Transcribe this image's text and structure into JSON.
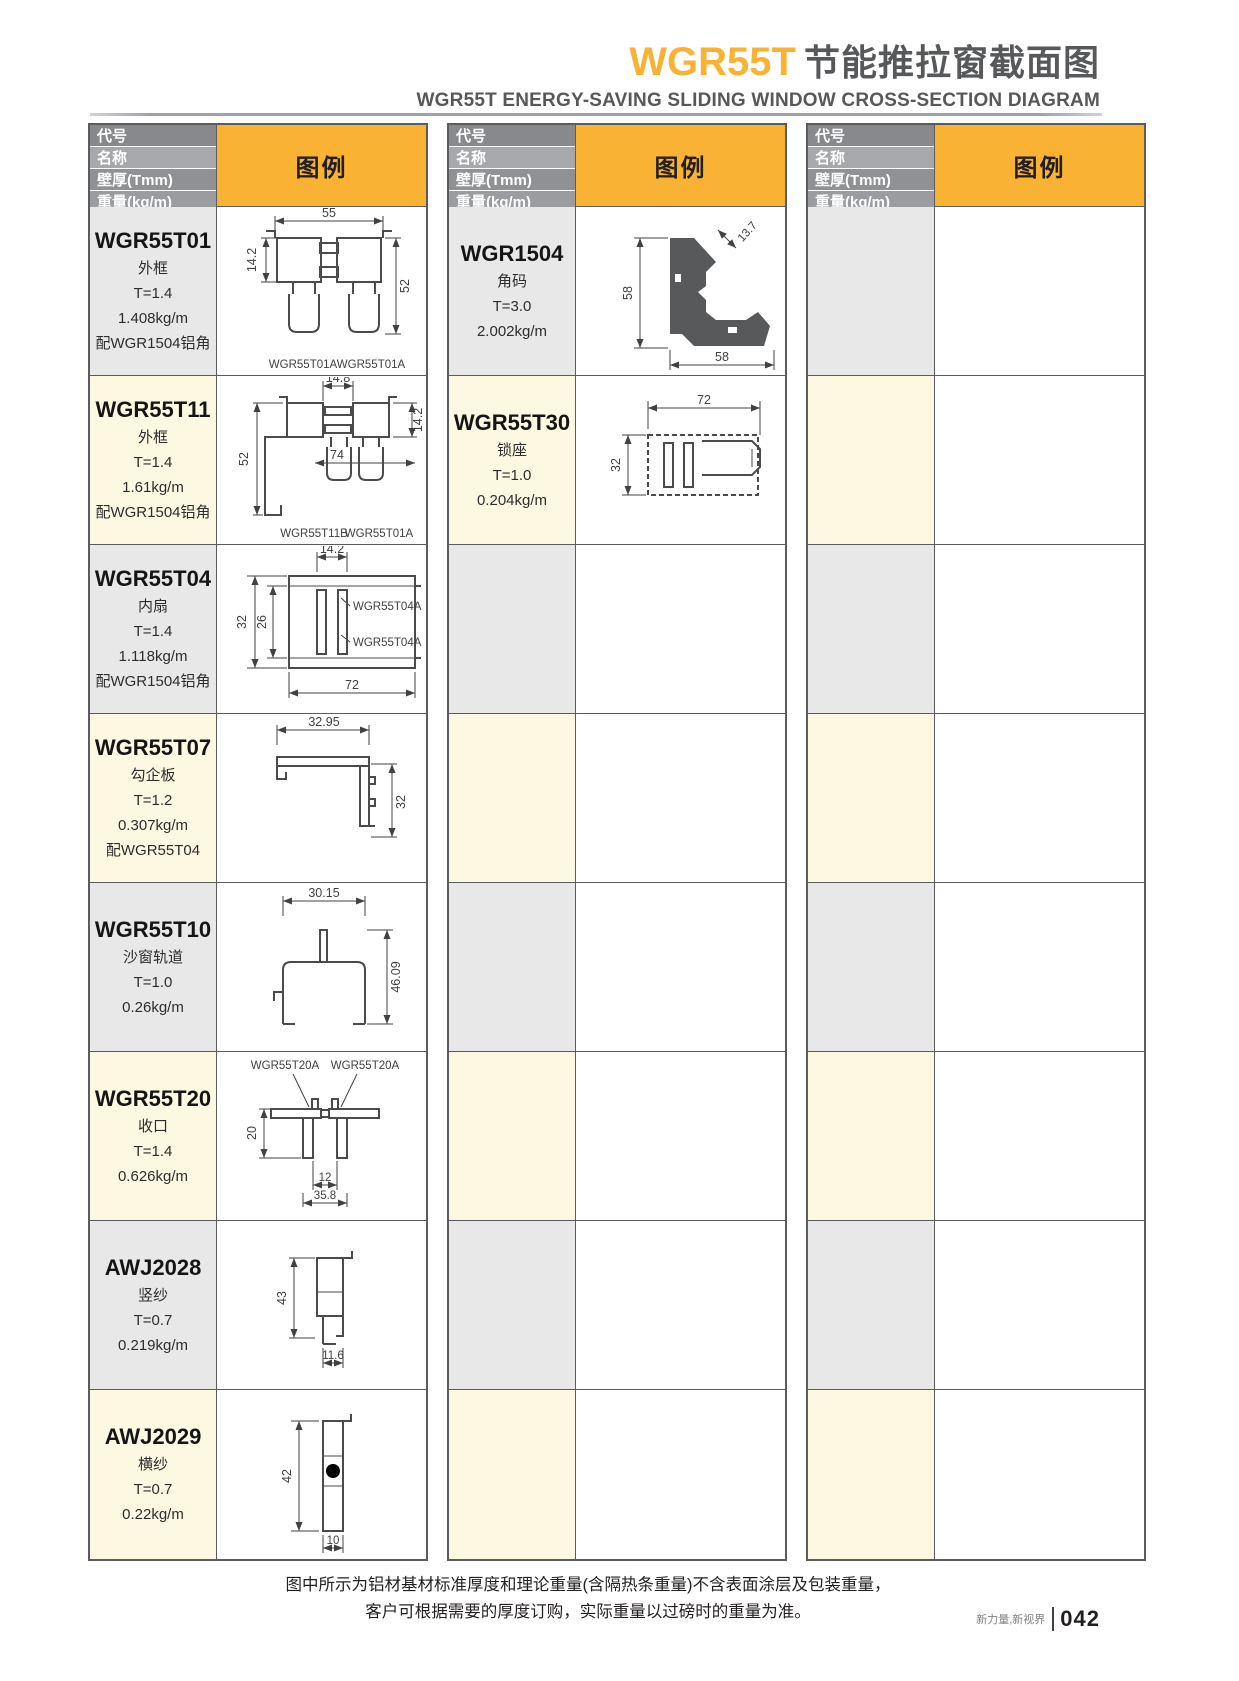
{
  "page": {
    "title_code": "WGR55T",
    "title_zh": "节能推拉窗截面图",
    "subtitle": "WGR55T ENERGY-SAVING SLIDING WINDOW CROSS-SECTION DIAGRAM",
    "note_line1": "图中所示为铝材基材标准厚度和理论重量(含隔热条重量)不含表面涂层及包装重量，",
    "note_line2": "客户可根据需要的厚度订购，实际重量以过磅时的重量为准。",
    "footer_slogan": "新力量,新视界",
    "page_number": "042"
  },
  "colors": {
    "accent": "#F9B233",
    "header_gray": "#87898C",
    "row_gray": "#E8E8E9",
    "row_cream": "#FDF8E1",
    "border": "#5B5C5E",
    "profile_line": "#4A4B4D",
    "bracket_fill": "#58595B"
  },
  "table_header": {
    "row_labels": [
      "代号",
      "名称",
      "壁厚(Tmm)",
      "重量(kg/m)"
    ],
    "legend_label": "图例"
  },
  "columns": [
    {
      "rows": [
        {
          "code": "WGR55T01",
          "name": "外框",
          "thickness": "T=1.4",
          "weight": "1.408kg/m",
          "note": "配WGR1504铝角",
          "dims": {
            "top": "55",
            "left": "14.2",
            "right": "52"
          },
          "sublabels": [
            "WGR55T01A",
            "WGR55T01A"
          ]
        },
        {
          "code": "WGR55T11",
          "name": "外框",
          "thickness": "T=1.4",
          "weight": "1.61kg/m",
          "note": "配WGR1504铝角",
          "dims": {
            "top": "14.8",
            "left": "52",
            "mid": "74",
            "right": "14.2"
          },
          "sublabels": [
            "WGR55T11B",
            "WGR55T01A"
          ]
        },
        {
          "code": "WGR55T04",
          "name": "内扇",
          "thickness": "T=1.4",
          "weight": "1.118kg/m",
          "note": "配WGR1504铝角",
          "dims": {
            "top": "14.2",
            "left": "32",
            "inner": "26",
            "bottom": "72"
          },
          "sublabels": [
            "WGR55T04A",
            "WGR55T04A"
          ]
        },
        {
          "code": "WGR55T07",
          "name": "勾企板",
          "thickness": "T=1.2",
          "weight": "0.307kg/m",
          "note": "配WGR55T04",
          "dims": {
            "top": "32.95",
            "right": "32"
          }
        },
        {
          "code": "WGR55T10",
          "name": "沙窗轨道",
          "thickness": "T=1.0",
          "weight": "0.26kg/m",
          "dims": {
            "top": "30.15",
            "right": "46.09"
          }
        },
        {
          "code": "WGR55T20",
          "name": "收口",
          "thickness": "T=1.4",
          "weight": "0.626kg/m",
          "dims": {
            "left": "20",
            "gap": "12",
            "bottom": "35.8"
          },
          "sublabels": [
            "WGR55T20A",
            "WGR55T20A"
          ]
        },
        {
          "code": "AWJ2028",
          "name": "竖纱",
          "thickness": "T=0.7",
          "weight": "0.219kg/m",
          "dims": {
            "left": "43",
            "bottom": "11.6"
          }
        },
        {
          "code": "AWJ2029",
          "name": "横纱",
          "thickness": "T=0.7",
          "weight": "0.22kg/m",
          "dims": {
            "left": "42",
            "bottom": "10"
          }
        }
      ]
    },
    {
      "rows": [
        {
          "code": "WGR1504",
          "name": "角码",
          "thickness": "T=3.0",
          "weight": "2.002kg/m",
          "dims": {
            "left": "58",
            "bottom": "58",
            "angle": "13.7"
          }
        },
        {
          "code": "WGR55T30",
          "name": "锁座",
          "thickness": "T=1.0",
          "weight": "0.204kg/m",
          "dims": {
            "top": "72",
            "left": "32"
          }
        }
      ]
    },
    {
      "rows": []
    }
  ]
}
